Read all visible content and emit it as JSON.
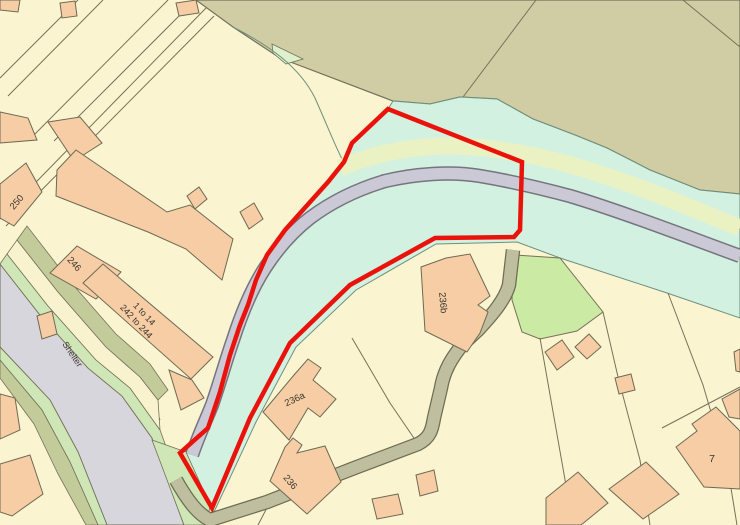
{
  "map": {
    "type": "ordnance-survey-style site location plan",
    "labels": {
      "b250": "250",
      "b246": "246",
      "flats_line1": "1 to 14",
      "flats_line2": "242 to 244",
      "shelter": "Shelter",
      "b236b": "236b",
      "b236a": "236a",
      "b236": "236",
      "b7": "7"
    },
    "colors": {
      "boundary_red": "#E9130B",
      "building_fill": "#F6CDA5",
      "parcel_cream": "#FBF4D0",
      "field_olive": "#D0CDA4",
      "site_mint": "#D2F1E1",
      "track_grey": "#CBC9D6",
      "road_grey": "#D7D6DC",
      "verge_green": "#CFE7B6",
      "bright_green": "#CBEAA3",
      "pale_strip": "#EAF2C3",
      "drive_olive": "#BFBF9F"
    }
  }
}
